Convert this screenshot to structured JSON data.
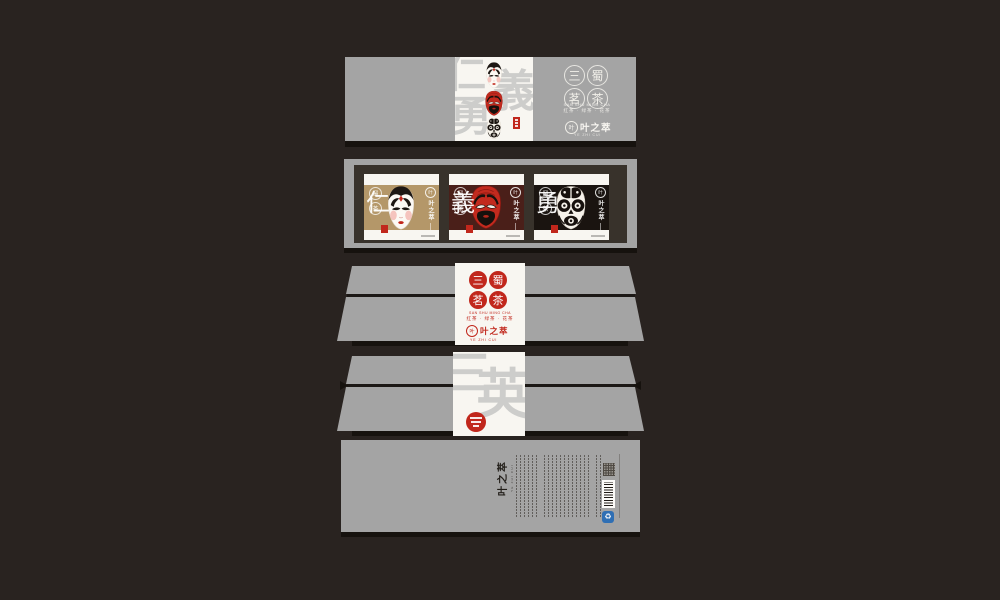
{
  "colors": {
    "background": "#292320",
    "box_gray": "#a4a4a4",
    "panel_white": "#f8f6f1",
    "frame_dark": "#38322b",
    "shadow": "#16120e",
    "accent_red": "#c1271c",
    "card_gold": "#b49769",
    "card_maroon": "#4a1f19",
    "card_black": "#1a1410",
    "watermark_gray": "#cdcdcb",
    "barcode_white": "#fcfbf8",
    "recycle_blue": "#2f6fb4",
    "logo_ink": "#221e19"
  },
  "brand": {
    "seal_characters": [
      "三",
      "蜀",
      "茗",
      "茶"
    ],
    "tagline_pinyin": "SAN SHU MING CHA",
    "tagline_cn": "红茶 · 绿茶 · 花茶",
    "logo_name": "叶之萃",
    "logo_sub": "YE ZHI CUI",
    "emblem_character": "叶",
    "mini_seal_characters": [
      "蜀",
      "茶"
    ]
  },
  "lid": {
    "watermark_characters": [
      "仁",
      "義",
      "勇"
    ]
  },
  "cards": [
    {
      "virtue": "仁",
      "mask": "white-opera-face-mask"
    },
    {
      "virtue": "義",
      "mask": "red-opera-face-mask"
    },
    {
      "virtue": "勇",
      "mask": "black-opera-face-mask"
    }
  ],
  "band_back": {
    "watermark_characters": [
      "三",
      "英"
    ]
  },
  "base": {
    "logo_name": "叶之萃",
    "logo_sub": "YE ZHI CUI"
  },
  "icons": {
    "masks": [
      "white-opera-face-mask",
      "red-opera-face-mask",
      "black-opera-face-mask"
    ],
    "recycle": "♻"
  }
}
